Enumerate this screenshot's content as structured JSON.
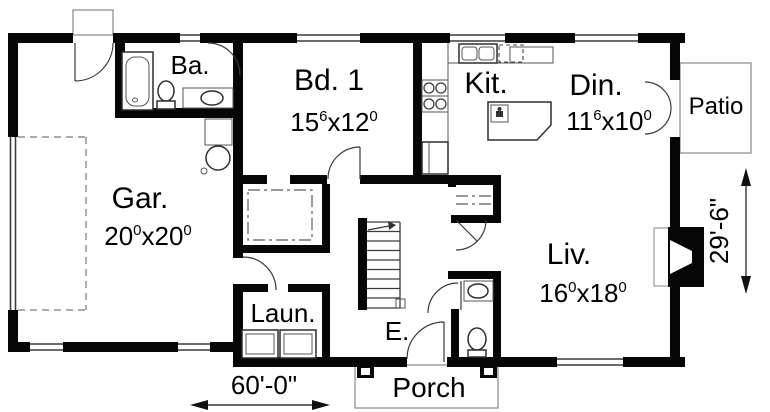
{
  "plan": {
    "rooms": {
      "garage": {
        "label": "Gar.",
        "d1": "20",
        "s1": "0",
        "d2": "x20",
        "s2": "0"
      },
      "bathroom": {
        "label": "Ba."
      },
      "bedroom1": {
        "label": "Bd. 1",
        "d1": "15",
        "s1": "6",
        "d2": "x12",
        "s2": "0"
      },
      "kitchen": {
        "label": "Kit."
      },
      "dining": {
        "label": "Din.",
        "d1": "11",
        "s1": "6",
        "d2": "x10",
        "s2": "0"
      },
      "living": {
        "label": "Liv.",
        "d1": "16",
        "s1": "0",
        "d2": "x18",
        "s2": "0"
      },
      "laundry": {
        "label": "Laun."
      },
      "entry": {
        "label": "E."
      },
      "porch": {
        "label": "Porch"
      },
      "patio": {
        "label": "Patio"
      }
    },
    "dimensions": {
      "overall_width": "60'-0\"",
      "overall_depth": "29'-6\""
    },
    "colors": {
      "wall": "#060606",
      "line": "#3a3a3a",
      "background": "#ffffff"
    }
  }
}
